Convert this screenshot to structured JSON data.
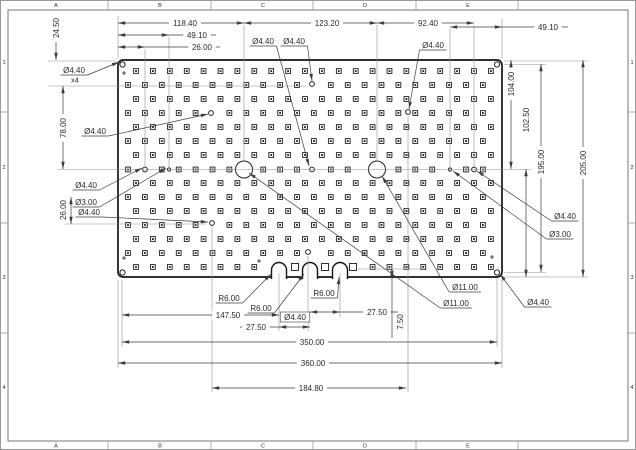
{
  "colors": {
    "outline": "#141414",
    "dim": "#3c3c3c",
    "ext": "#8f8f8f",
    "frame": "#9a9a9a",
    "pad": "#1c1c1c",
    "text": "#2a2a2a",
    "bg": "#ffffff"
  },
  "sheet": {
    "zone_letters": [
      "A",
      "B",
      "C",
      "D",
      "E"
    ],
    "zone_letter_x": [
      56,
      160,
      263,
      365,
      468
    ],
    "zone_numbers": [
      "1",
      "2",
      "3",
      "4"
    ],
    "zone_number_y": [
      62,
      167,
      277,
      387
    ],
    "tick_x": [
      108,
      211,
      313,
      416,
      518
    ],
    "tick_y": [
      112,
      223,
      333
    ],
    "inner_frame": {
      "x": 8,
      "y": 10,
      "w": 620,
      "h": 431
    }
  },
  "plate": {
    "x": 118,
    "y": 60,
    "w": 384,
    "h": 217,
    "rx": 5,
    "slots": {
      "centers_x": [
        279,
        310,
        340
      ],
      "radius": 7.5,
      "arc_cy": 270,
      "open_to_y": 279
    },
    "corner_holes": [
      {
        "x": 122.5,
        "y": 64.5,
        "r": 2.6
      },
      {
        "x": 497,
        "y": 64.5,
        "r": 2.6
      },
      {
        "x": 122.5,
        "y": 272.5,
        "r": 2.6
      },
      {
        "x": 497,
        "y": 272.5,
        "r": 2.6
      }
    ],
    "big_holes": [
      {
        "x": 244,
        "y": 169.5,
        "r": 8.5
      },
      {
        "x": 377,
        "y": 169.5,
        "r": 8.5
      }
    ],
    "small_holes": [
      {
        "x": 145,
        "y": 169.5,
        "r": 2.4
      },
      {
        "x": 312,
        "y": 169.5,
        "r": 2.4
      },
      {
        "x": 474,
        "y": 169.5,
        "r": 2.4
      },
      {
        "x": 211,
        "y": 113,
        "r": 2.4
      },
      {
        "x": 408,
        "y": 112,
        "r": 2.4
      },
      {
        "x": 312,
        "y": 84,
        "r": 2.4
      },
      {
        "x": 308,
        "y": 252,
        "r": 2.4
      },
      {
        "x": 212,
        "y": 223,
        "r": 2.4
      },
      {
        "x": 169,
        "y": 169.5,
        "r": 1.6
      },
      {
        "x": 450,
        "y": 169.5,
        "r": 1.6
      }
    ],
    "tiny_holes": [
      {
        "x": 124,
        "y": 73,
        "r": 1.1
      },
      {
        "x": 124,
        "y": 258,
        "r": 1.1
      },
      {
        "x": 492,
        "y": 257,
        "r": 1.1
      },
      {
        "x": 259,
        "y": 261,
        "r": 1.1
      }
    ],
    "plain_squares": [
      {
        "x": 295,
        "y": 267
      },
      {
        "x": 325,
        "y": 267
      },
      {
        "x": 353,
        "y": 267
      }
    ],
    "pad_grid": {
      "row_y": [
        71,
        85,
        99,
        113,
        127,
        141,
        155,
        169.5,
        183,
        197,
        211,
        225,
        239,
        253,
        267
      ],
      "col_count": 22,
      "col_spacing": 16.9,
      "offset_even": 136,
      "offset_odd": 128,
      "slot_skip": {
        "row_y": 267,
        "x_min": 260,
        "x_max": 358
      }
    }
  },
  "dims": {
    "horizontal": [
      {
        "label": "118.40",
        "y": 23,
        "x1": 118,
        "x2": 244,
        "tx": 185
      },
      {
        "label": "123.20",
        "y": 23,
        "x1": 244,
        "x2": 377,
        "tx": 327
      },
      {
        "label": "92.40",
        "y": 23,
        "x1": 377,
        "x2": 474,
        "tx": 428
      },
      {
        "label": "49.10",
        "y": 35,
        "x1": 118,
        "x2": 169,
        "tx": 197,
        "lx2": 216
      },
      {
        "label": "26.00",
        "y": 47,
        "x1": 118,
        "x2": 145,
        "tx": 202,
        "lx2": 220
      },
      {
        "label": "49.10",
        "y": 27,
        "x1": 450,
        "x2": 502,
        "tx": 548,
        "lx2": 568
      },
      {
        "label": "147.50",
        "y": 315,
        "x1": 122,
        "x2": 279,
        "tx": 228
      },
      {
        "label": "27.50",
        "y": 327,
        "x1": 279,
        "x2": 310,
        "tx": 256,
        "lx1": 240
      },
      {
        "label": "27.50",
        "y": 312,
        "x1": 310,
        "x2": 340,
        "tx": 377,
        "lx2": 398
      },
      {
        "label": "350.00",
        "y": 342,
        "x1": 122,
        "x2": 497,
        "tx": 312
      },
      {
        "label": "360.00",
        "y": 363,
        "x1": 118,
        "x2": 502,
        "tx": 313
      },
      {
        "label": "184.80",
        "y": 388,
        "x1": 212,
        "x2": 406,
        "tx": 311
      }
    ],
    "vertical": [
      {
        "label": "24.50",
        "x": 56,
        "y1": 42,
        "y2": 60,
        "ty": 28,
        "variant": "tip-bottom",
        "nochip": true
      },
      {
        "label": "78.00",
        "x": 63,
        "y1": 86,
        "y2": 169,
        "ty": 128
      },
      {
        "label": "26.00",
        "x": 71,
        "y1": 197,
        "y2": 224,
        "ty": 210,
        "tx": 63,
        "nochip": true
      },
      {
        "label": "104.00",
        "x": 511,
        "y1": 60,
        "y2": 169,
        "ty": 84
      },
      {
        "label": "102.50",
        "x": 526,
        "y1": 169,
        "y2": 277,
        "ty": 120
      },
      {
        "label": "195.00",
        "x": 541,
        "y1": 64,
        "y2": 272,
        "ty": 162
      },
      {
        "label": "205.00",
        "x": 583,
        "y1": 60,
        "y2": 277,
        "ty": 163
      },
      {
        "label": "7.50",
        "x": 392,
        "y1": 269,
        "y2": 278,
        "ty": 322,
        "tx": 400,
        "variant": "notch",
        "lineto": 338,
        "nochip": true
      }
    ],
    "leaders": [
      {
        "label": "Ø4.40",
        "label2": "x4",
        "tx": 74,
        "ty": 70,
        "tipx": 119,
        "tipy": 62
      },
      {
        "label": "Ø4.40",
        "tx": 95,
        "ty": 131,
        "tipx": 208,
        "tipy": 114
      },
      {
        "label": "Ø4.40",
        "tx": 86,
        "ty": 185,
        "tipx": 142,
        "tipy": 168
      },
      {
        "label": "Ø3.00",
        "tx": 86,
        "ty": 202,
        "tipx": 166,
        "tipy": 168
      },
      {
        "label": "Ø4.40",
        "tx": 89,
        "ty": 212,
        "tipx": 208,
        "tipy": 222
      },
      {
        "label": "Ø4.40",
        "tx": 263,
        "ty": 41,
        "tipx": 309,
        "tipy": 166
      },
      {
        "label": "Ø4.40",
        "tx": 294,
        "ty": 41,
        "tipx": 312,
        "tipy": 81
      },
      {
        "label": "Ø4.40",
        "tx": 433,
        "ty": 45,
        "tipx": 409,
        "tipy": 109
      },
      {
        "label": "Ø4.40",
        "tx": 565,
        "ty": 216,
        "tipx": 477,
        "tipy": 171
      },
      {
        "label": "Ø3.00",
        "tx": 560,
        "ty": 234,
        "tipx": 453,
        "tipy": 171
      },
      {
        "label": "Ø11.00",
        "tx": 465,
        "ty": 287,
        "tipx": 382,
        "tipy": 176
      },
      {
        "label": "Ø11.00",
        "tx": 456,
        "ty": 303,
        "tipx": 249,
        "tipy": 173
      },
      {
        "label": "Ø4.40",
        "tx": 538,
        "ty": 302,
        "tipx": 500,
        "tipy": 274
      },
      {
        "label": "R6.00",
        "tx": 229,
        "ty": 298,
        "tipx": 271,
        "tipy": 274
      },
      {
        "label": "R6.00",
        "tx": 261,
        "ty": 308,
        "tipx": 304,
        "tipy": 274
      },
      {
        "label": "R6.00",
        "tx": 324,
        "ty": 293,
        "tipx": 339,
        "tipy": 277
      }
    ],
    "boxed_labels": [
      {
        "label": "Ø4.40",
        "tx": 295,
        "ty": 317
      }
    ],
    "ext_lines": [
      [
        48,
        61,
        116,
        61
      ],
      [
        48,
        86,
        306,
        86
      ],
      [
        58,
        169.5,
        532,
        169.5
      ],
      [
        145,
        49,
        145,
        167
      ],
      [
        169,
        37,
        169,
        167
      ],
      [
        244,
        25,
        244,
        161
      ],
      [
        377,
        25,
        377,
        161
      ],
      [
        450,
        29,
        450,
        167
      ],
      [
        474,
        25,
        474,
        167
      ],
      [
        502,
        18,
        502,
        58
      ],
      [
        118,
        16,
        118,
        58
      ],
      [
        118,
        280,
        118,
        368
      ],
      [
        122,
        280,
        122,
        347
      ],
      [
        497,
        278,
        497,
        347
      ],
      [
        502,
        280,
        502,
        368
      ],
      [
        212,
        226,
        212,
        392
      ],
      [
        408,
        116,
        408,
        392
      ],
      [
        308,
        256,
        308,
        331
      ],
      [
        279,
        273,
        279,
        331
      ],
      [
        340,
        273,
        340,
        317
      ],
      [
        65,
        224,
        206,
        224
      ],
      [
        358,
        269,
        425,
        269
      ],
      [
        504,
        61,
        588,
        61
      ],
      [
        504,
        64.5,
        546,
        64.5
      ],
      [
        504,
        272.5,
        546,
        272.5
      ],
      [
        504,
        277,
        588,
        277
      ]
    ]
  }
}
